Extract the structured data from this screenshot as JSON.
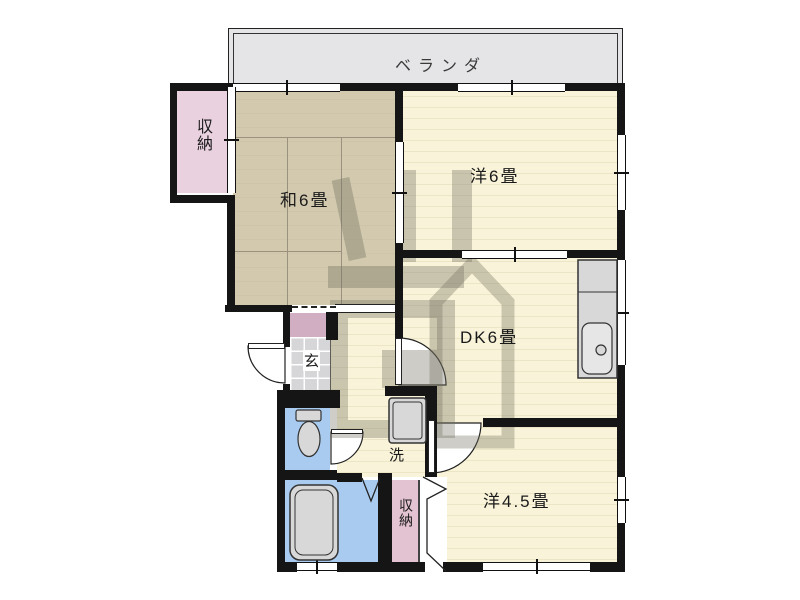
{
  "plan": {
    "type": "apartment-floor-plan",
    "rooms": {
      "balcony": {
        "label": "ベランダ"
      },
      "storage_top_left": {
        "label": "収納"
      },
      "japanese_room": {
        "label": "和6畳",
        "tatami": 6
      },
      "western_room_6": {
        "label": "洋6畳",
        "tatami": 6
      },
      "dining_kitchen": {
        "label": "DK6畳",
        "tatami": 6
      },
      "western_room_45": {
        "label": "洋4.5畳",
        "tatami": 4.5
      },
      "entrance": {
        "label": "玄"
      },
      "laundry": {
        "label": "洗"
      },
      "storage_bottom": {
        "label": "収納"
      }
    },
    "watermark": {
      "text": "川商"
    },
    "colors": {
      "wall": "#151515",
      "tatami_floor": "#d2c9ae",
      "wood_floor": "#f9f4d9",
      "balcony_gray": "#e5e5e7",
      "storage_pink": "#e9d1df",
      "closet_pink": "#d2aec2",
      "water_blue": "#a9cbf0",
      "fixture_gray": "#d8d8d8",
      "tile_gray": "#d6d6d8",
      "watermark_gray": "#6e6b5c"
    }
  }
}
